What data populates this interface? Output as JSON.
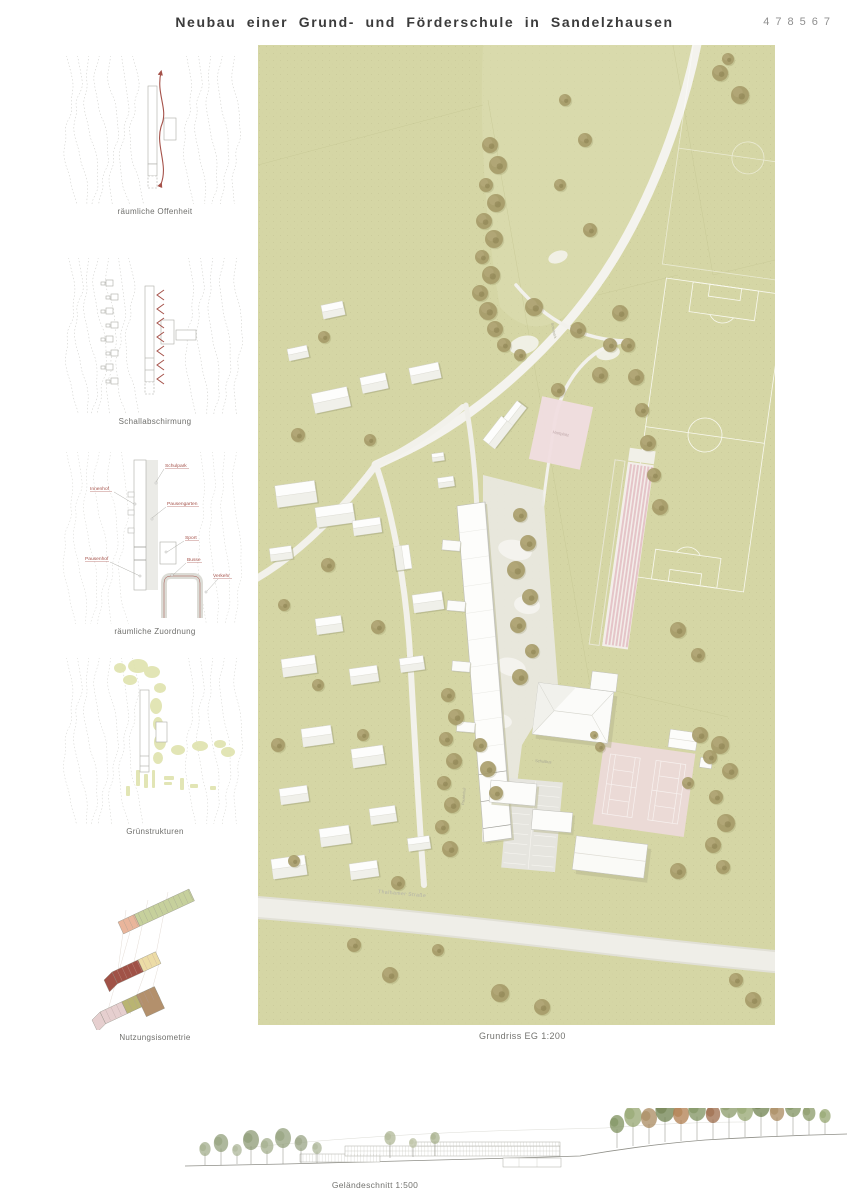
{
  "header": {
    "title": "Neubau einer Grund- und Förderschule in Sandelzhausen",
    "project_number": "478567"
  },
  "sidebar": {
    "diagrams": [
      {
        "label": "räumliche Offenheit"
      },
      {
        "label": "Schallabschirmung"
      },
      {
        "label": "räumliche Zuordnung",
        "annotations": [
          "Schulpark",
          "Innenhof",
          "Pausengarten",
          "Sport",
          "Pausenhof",
          "Busse",
          "Verkehr"
        ]
      },
      {
        "label": "Grünstrukturen"
      },
      {
        "label": "Nutzungsisometrie"
      }
    ]
  },
  "main_plan": {
    "caption": "Grundriss EG 1:200",
    "labels": {
      "street": "Thalhamer Straße",
      "hartplatz": "Hartplatz",
      "schulbus": "Schulbus",
      "schulpark": "Schulpark",
      "pausenhof": "Pausenhof"
    }
  },
  "section": {
    "caption": "Geländeschnitt 1:500"
  },
  "colors": {
    "accent_red": "#a5524a",
    "site_green": "#d5d6a5",
    "sport_pink": "#ecd9d8",
    "tree_olive": "#a59a68"
  }
}
